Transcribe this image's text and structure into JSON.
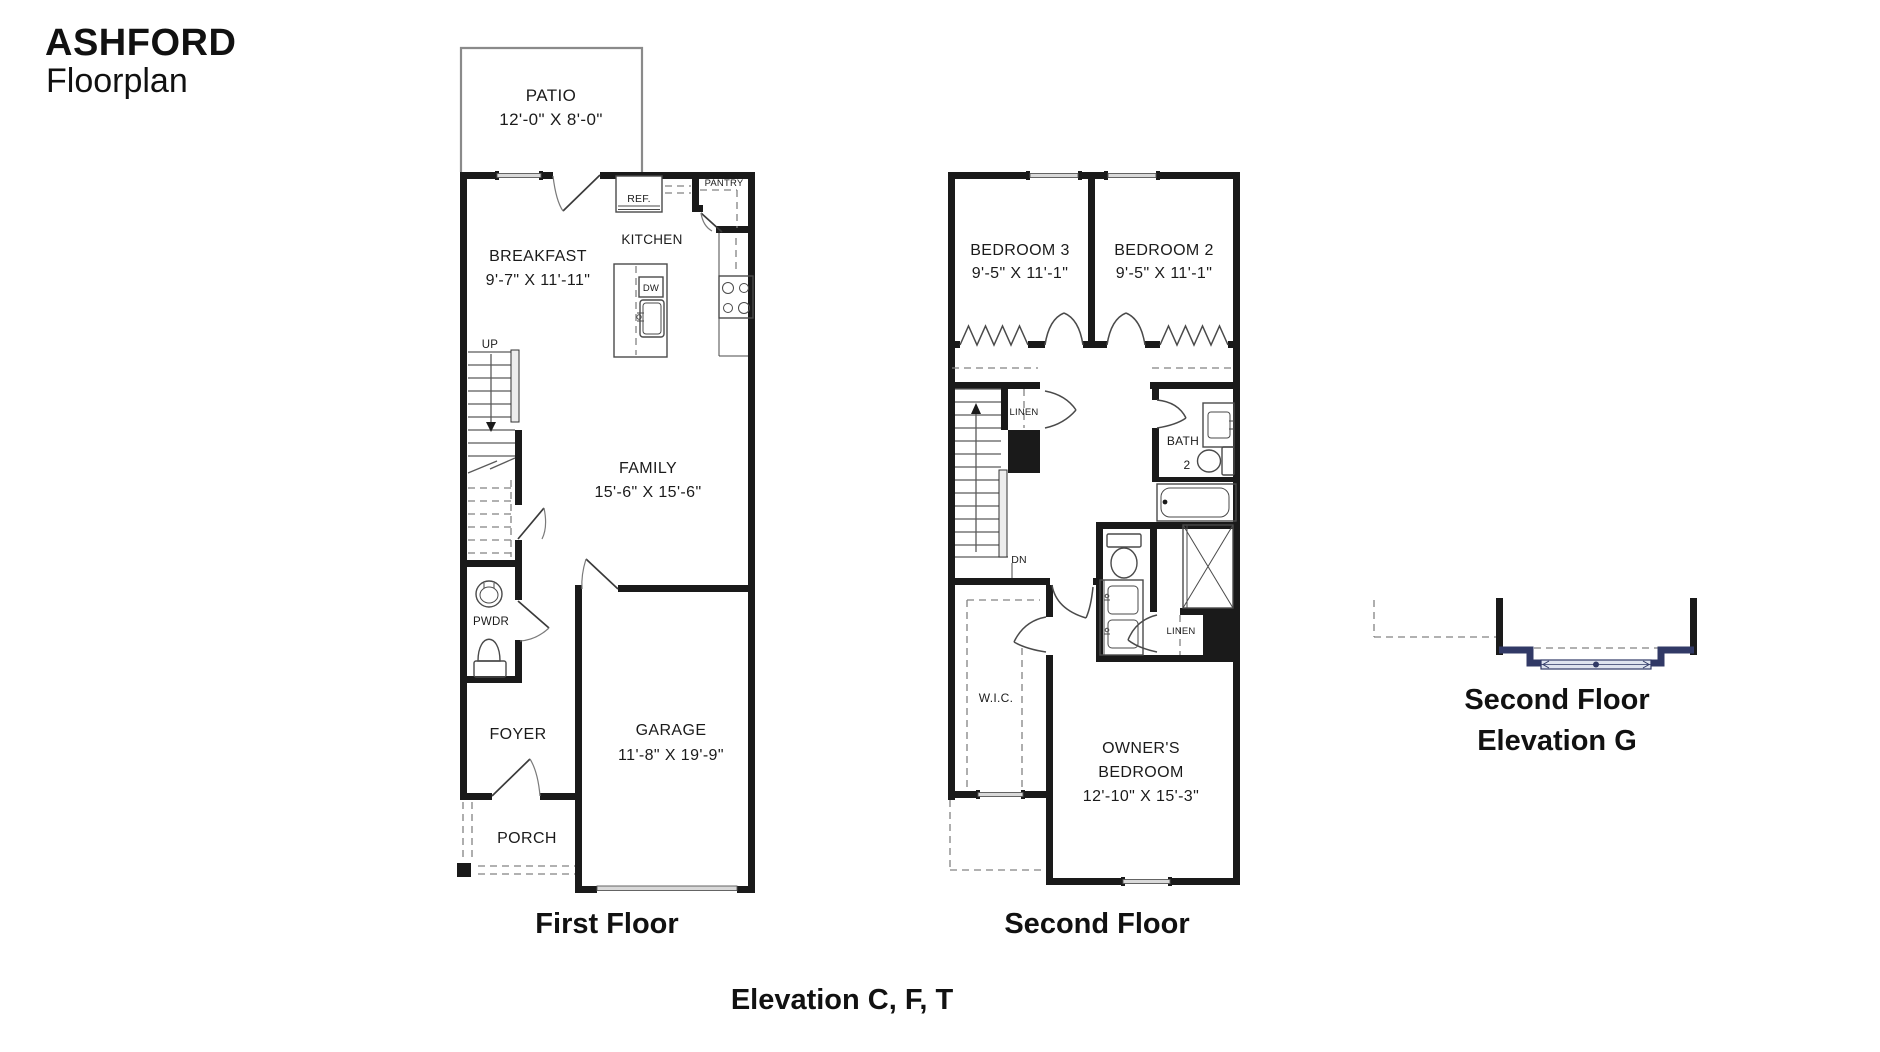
{
  "title": {
    "name": "ASHFORD",
    "subtitle": "Floorplan"
  },
  "first_floor": {
    "caption": "First Floor",
    "patio_label": "PATIO",
    "patio_dims": "12'-0\" X 8'-0\"",
    "ref_label": "REF.",
    "pantry_label": "PANTRY",
    "kitchen_label": "KITCHEN",
    "breakfast_label": "BREAKFAST",
    "breakfast_dims": "9'-7\" X 11'-11\"",
    "dw_label": "DW",
    "up_label": "UP",
    "family_label": "FAMILY",
    "family_dims": "15'-6\" X 15'-6\"",
    "pwdr_label": "PWDR",
    "foyer_label": "FOYER",
    "garage_label": "GARAGE",
    "garage_dims": "11'-8\" X 19'-9\"",
    "porch_label": "PORCH"
  },
  "second_floor": {
    "caption": "Second Floor",
    "bedroom3_label": "BEDROOM 3",
    "bedroom3_dims": "9'-5\" X 11'-1\"",
    "bedroom2_label": "BEDROOM 2",
    "bedroom2_dims": "9'-5\" X 11'-1\"",
    "linen_label": "LINEN",
    "bath2_line1": "BATH",
    "bath2_line2": "2",
    "dn_label": "DN",
    "wic_label": "W.I.C.",
    "owners_line1": "OWNER'S",
    "owners_line2": "BEDROOM",
    "owners_dims": "12'-10\" X 15'-3\"",
    "linen2_label": "LINEN"
  },
  "elevation_g": {
    "caption_line1": "Second Floor",
    "caption_line2": "Elevation G"
  },
  "footer": {
    "elevation_label": "Elevation C, F, T"
  },
  "colors": {
    "wall": "#1a1a1a",
    "accent_navy": "#313966",
    "window_gray": "#d9d9d9"
  }
}
